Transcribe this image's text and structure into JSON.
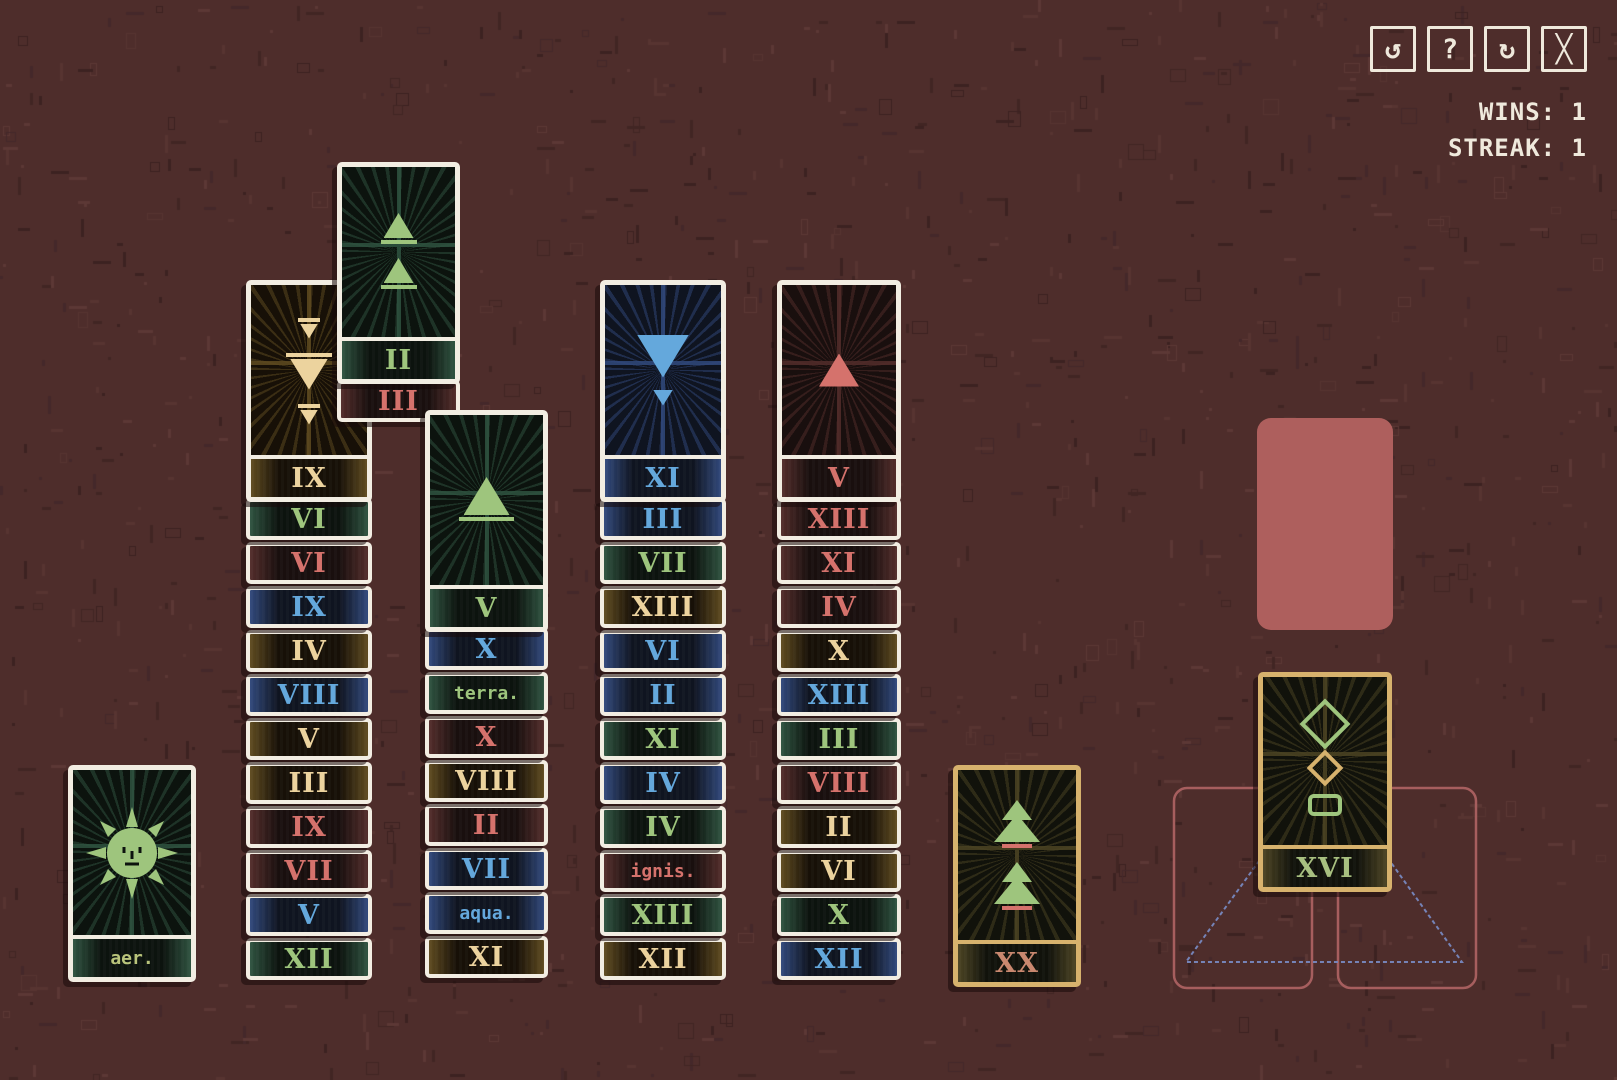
{
  "header": {
    "wins_label": "WINS: 1",
    "streak_label": "STREAK: 1",
    "buttons": [
      {
        "name": "undo-button",
        "icon": "undo-icon",
        "glyph": "↺"
      },
      {
        "name": "help-button",
        "icon": "question-icon",
        "glyph": "?"
      },
      {
        "name": "restart-button",
        "icon": "restart-icon",
        "glyph": "↻"
      },
      {
        "name": "close-button",
        "icon": "close-icon",
        "glyph": "╳"
      }
    ]
  },
  "palette": {
    "background": "#4e2d2b",
    "card_border_white": "#f2ede2",
    "card_border_gold": "#d7b26d",
    "suit_air": "#ecd39e",
    "suit_earth": "#9ec57d",
    "suit_fire": "#d5726c",
    "suit_water": "#64a8dc",
    "empty_slot_red": "#ae5f5d",
    "slot_outline_red": "#a65e5e",
    "triangle_blue": "#7583b7"
  },
  "columns": [
    {
      "name": "column-1",
      "cards": [
        {
          "v": "IX",
          "suit": "air",
          "big": true,
          "glyphs": [
            18,
            38,
            18
          ]
        },
        {
          "v": "VI",
          "suit": "earth"
        },
        {
          "v": "VI",
          "suit": "fire"
        },
        {
          "v": "IX",
          "suit": "water"
        },
        {
          "v": "IV",
          "suit": "air"
        },
        {
          "v": "VIII",
          "suit": "water"
        },
        {
          "v": "V",
          "suit": "air"
        },
        {
          "v": "III",
          "suit": "air"
        },
        {
          "v": "IX",
          "suit": "fire"
        },
        {
          "v": "VII",
          "suit": "fire"
        },
        {
          "v": "V",
          "suit": "water"
        },
        {
          "v": "XII",
          "suit": "earth"
        }
      ]
    },
    {
      "name": "column-2",
      "cards": [
        {
          "v": "II",
          "suit": "earth",
          "big": true,
          "glyphs": [
            30,
            30
          ]
        },
        {
          "v": "III",
          "suit": "fire"
        }
      ]
    },
    {
      "name": "column-3",
      "cards": [
        {
          "v": "V",
          "suit": "earth",
          "big": true,
          "glyphs": [
            46
          ]
        },
        {
          "v": "X",
          "suit": "water"
        },
        {
          "text": "terra.",
          "suit": "earth"
        },
        {
          "v": "X",
          "suit": "fire"
        },
        {
          "v": "VIII",
          "suit": "air"
        },
        {
          "v": "II",
          "suit": "fire"
        },
        {
          "v": "VII",
          "suit": "water"
        },
        {
          "text": "aqua.",
          "suit": "water"
        },
        {
          "v": "XI",
          "suit": "air"
        }
      ]
    },
    {
      "name": "column-4",
      "cards": [
        {
          "v": "XI",
          "suit": "water",
          "big": true,
          "glyphs": [
            52,
            20
          ]
        },
        {
          "v": "III",
          "suit": "water"
        },
        {
          "v": "VII",
          "suit": "earth"
        },
        {
          "v": "XIII",
          "suit": "air"
        },
        {
          "v": "VI",
          "suit": "water"
        },
        {
          "v": "II",
          "suit": "water"
        },
        {
          "v": "XI",
          "suit": "earth"
        },
        {
          "v": "IV",
          "suit": "water"
        },
        {
          "v": "IV",
          "suit": "earth"
        },
        {
          "text": "ignis.",
          "suit": "fire"
        },
        {
          "v": "XIII",
          "suit": "earth"
        },
        {
          "v": "XII",
          "suit": "air"
        }
      ]
    },
    {
      "name": "column-5",
      "cards": [
        {
          "v": "V",
          "suit": "fire",
          "big": true,
          "glyphs": [
            40
          ]
        },
        {
          "v": "XIII",
          "suit": "fire"
        },
        {
          "v": "XI",
          "suit": "fire"
        },
        {
          "v": "IV",
          "suit": "fire"
        },
        {
          "v": "X",
          "suit": "air"
        },
        {
          "v": "XIII",
          "suit": "water"
        },
        {
          "v": "III",
          "suit": "earth"
        },
        {
          "v": "VIII",
          "suit": "fire"
        },
        {
          "v": "II",
          "suit": "air"
        },
        {
          "v": "VI",
          "suit": "air"
        },
        {
          "v": "X",
          "suit": "earth"
        },
        {
          "v": "XII",
          "suit": "water"
        }
      ]
    }
  ],
  "aer_card": {
    "label": "aer.",
    "art": "sun-face"
  },
  "arcana_xx": {
    "v": "XX",
    "art": "two-trees"
  },
  "right_panel": {
    "arcana_card": {
      "v": "XVI",
      "art": "lanterns"
    },
    "empty_cell": true,
    "foundation_slots": 2,
    "triangle_outline": true
  }
}
